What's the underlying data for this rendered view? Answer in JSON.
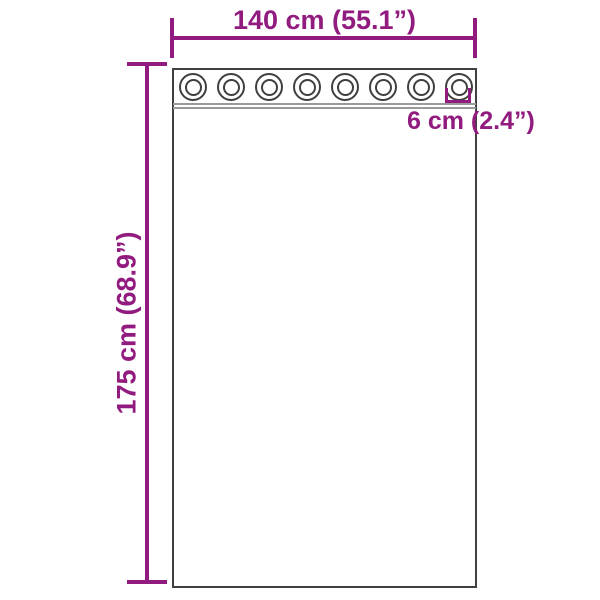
{
  "page": {
    "background": "#ffffff"
  },
  "colors": {
    "dimension": "#911b7e",
    "outline": "#404040",
    "separator": "#9a9a9a"
  },
  "diagram": {
    "width_label": "140 cm (55.1”)",
    "height_label": "175 cm (68.9”)",
    "grommet_size_label": "6 cm (2.4”)",
    "grommet_count": 8
  }
}
